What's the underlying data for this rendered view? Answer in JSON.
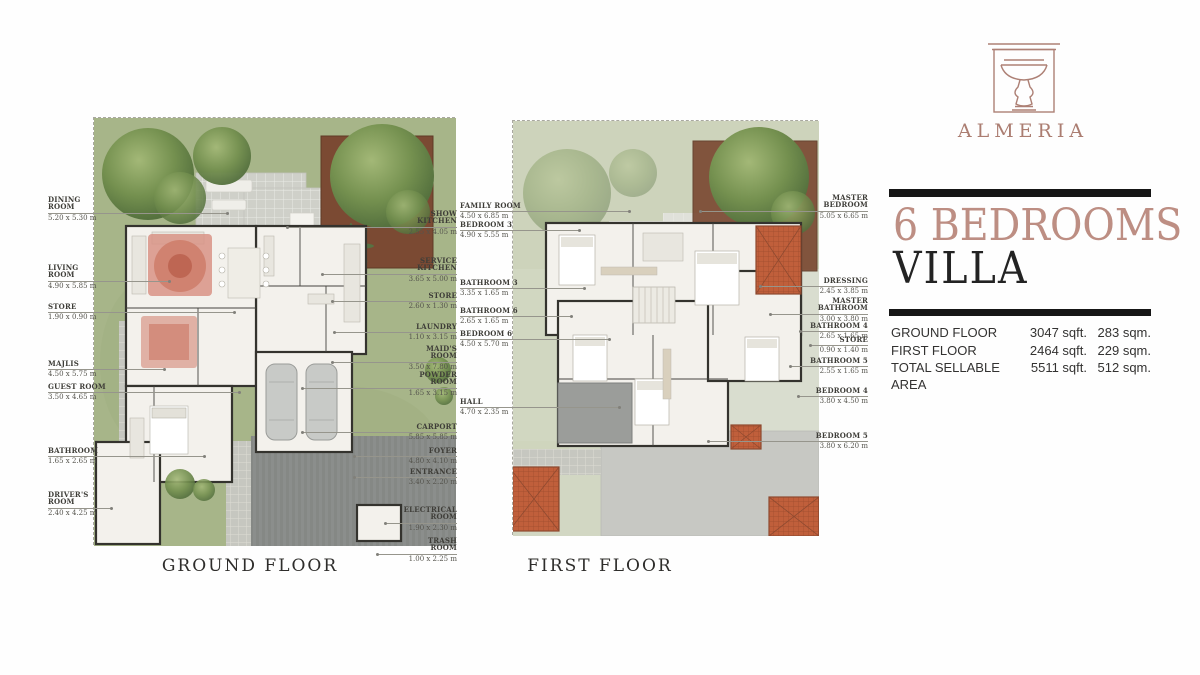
{
  "brand": {
    "name": "ALMERIA",
    "logo_icon": "fountain-icon",
    "accent_color": "#ad8075",
    "title_rose_color": "#bd8e83",
    "bar_color": "#161616"
  },
  "unit": {
    "line1": "6 BEDROOMS",
    "line2": "VILLA"
  },
  "areas": {
    "rows": [
      {
        "label": "GROUND FLOOR",
        "sqft": "3047 sqft.",
        "sqm": "283 sqm."
      },
      {
        "label": "FIRST FLOOR",
        "sqft": "2464 sqft.",
        "sqm": "229 sqm."
      },
      {
        "label": "TOTAL SELLABLE AREA",
        "sqft": "5511 sqft.",
        "sqm": "512 sqm."
      }
    ]
  },
  "ground_floor": {
    "title": "GROUND FLOOR",
    "labels_left": [
      {
        "name": "DINING\nROOM",
        "dims": "5.20 x 5.30 m"
      },
      {
        "name": "LIVING\nROOM",
        "dims": "4.90 x 5.85 m"
      },
      {
        "name": "STORE",
        "dims": "1.90 x 0.90 m"
      },
      {
        "name": "MAJLIS",
        "dims": "4.50 x 5.75 m"
      },
      {
        "name": "GUEST ROOM",
        "dims": "3.50 x 4.65 m"
      },
      {
        "name": "BATHROOM",
        "dims": "1.65 x 2.65 m"
      },
      {
        "name": "DRIVER'S\nROOM",
        "dims": "2.40 x 4.25 m"
      }
    ],
    "labels_right": [
      {
        "name": "SHOW\nKITCHEN",
        "dims": "2.55 x 4.05 m"
      },
      {
        "name": "SERVICE\nKITCHEN",
        "dims": "3.65 x 5.00 m"
      },
      {
        "name": "STORE",
        "dims": "2.60 x 1.30 m"
      },
      {
        "name": "LAUNDRY",
        "dims": "1.10 x 3.15 m"
      },
      {
        "name": "MAID'S\nROOM",
        "dims": "3.50 x 7.80 m"
      },
      {
        "name": "POWDER\nROOM",
        "dims": "1.65 x 3.15 m"
      },
      {
        "name": "CARPORT",
        "dims": "5.85 x 5.85 m"
      },
      {
        "name": "FOYER",
        "dims": "4.80 x 4.10 m"
      },
      {
        "name": "ENTRANCE",
        "dims": "3.40 x 2.20 m"
      },
      {
        "name": "ELECTRICAL\nROOM",
        "dims": "1.90 x 2.30 m"
      },
      {
        "name": "TRASH\nROOM",
        "dims": "1.00 x 2.25 m"
      }
    ]
  },
  "first_floor": {
    "title": "FIRST FLOOR",
    "labels_left": [
      {
        "name": "FAMILY ROOM",
        "dims": "4.50 x 6.85 m"
      },
      {
        "name": "BEDROOM 3",
        "dims": "4.90 x 5.55 m"
      },
      {
        "name": "BATHROOM 3",
        "dims": "3.35 x 1.65 m"
      },
      {
        "name": "BATHROOM 6",
        "dims": "2.65 x 1.65 m"
      },
      {
        "name": "BEDROOM 6",
        "dims": "4.50 x 5.70 m"
      },
      {
        "name": "HALL",
        "dims": "4.70 x 2.35 m"
      }
    ],
    "labels_right": [
      {
        "name": "MASTER\nBEDROOM",
        "dims": "5.05 x 6.65 m"
      },
      {
        "name": "DRESSING",
        "dims": "2.45 x 3.85 m"
      },
      {
        "name": "MASTER\nBATHROOM",
        "dims": "3.00 x 3.80 m"
      },
      {
        "name": "BATHROOM 4",
        "dims": "2.65 x 1.65 m"
      },
      {
        "name": "STORE",
        "dims": "0.90 x 1.40 m"
      },
      {
        "name": "BATHROOM 5",
        "dims": "2.55 x 1.65 m"
      },
      {
        "name": "BEDROOM 4",
        "dims": "3.80 x 4.50 m"
      },
      {
        "name": "BEDROOM 5",
        "dims": "3.80 x 6.20 m"
      }
    ]
  }
}
